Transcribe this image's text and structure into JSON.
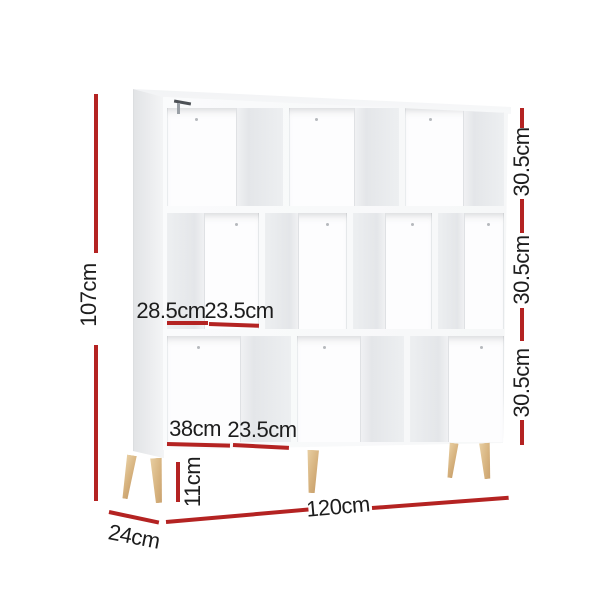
{
  "diagram": {
    "title": "bookshelf-dimension-diagram",
    "labels": {
      "total_height": "107cm",
      "row_height_top": "30.5cm",
      "row_height_middle": "30.5cm",
      "row_height_bottom": "30.5cm",
      "middle_cell_width_large": "28.5cm",
      "middle_cell_width_small": "23.5cm",
      "bottom_cell_width_large": "38cm",
      "bottom_cell_width_small": "23.5cm",
      "leg_height": "11cm",
      "total_width": "120cm",
      "total_depth": "24cm"
    },
    "colors": {
      "dimension_red": "#b42322",
      "label_text": "#1d1d1d",
      "wood_leg": "#d6b27e",
      "shelf_white": "#fdfdfe"
    }
  }
}
